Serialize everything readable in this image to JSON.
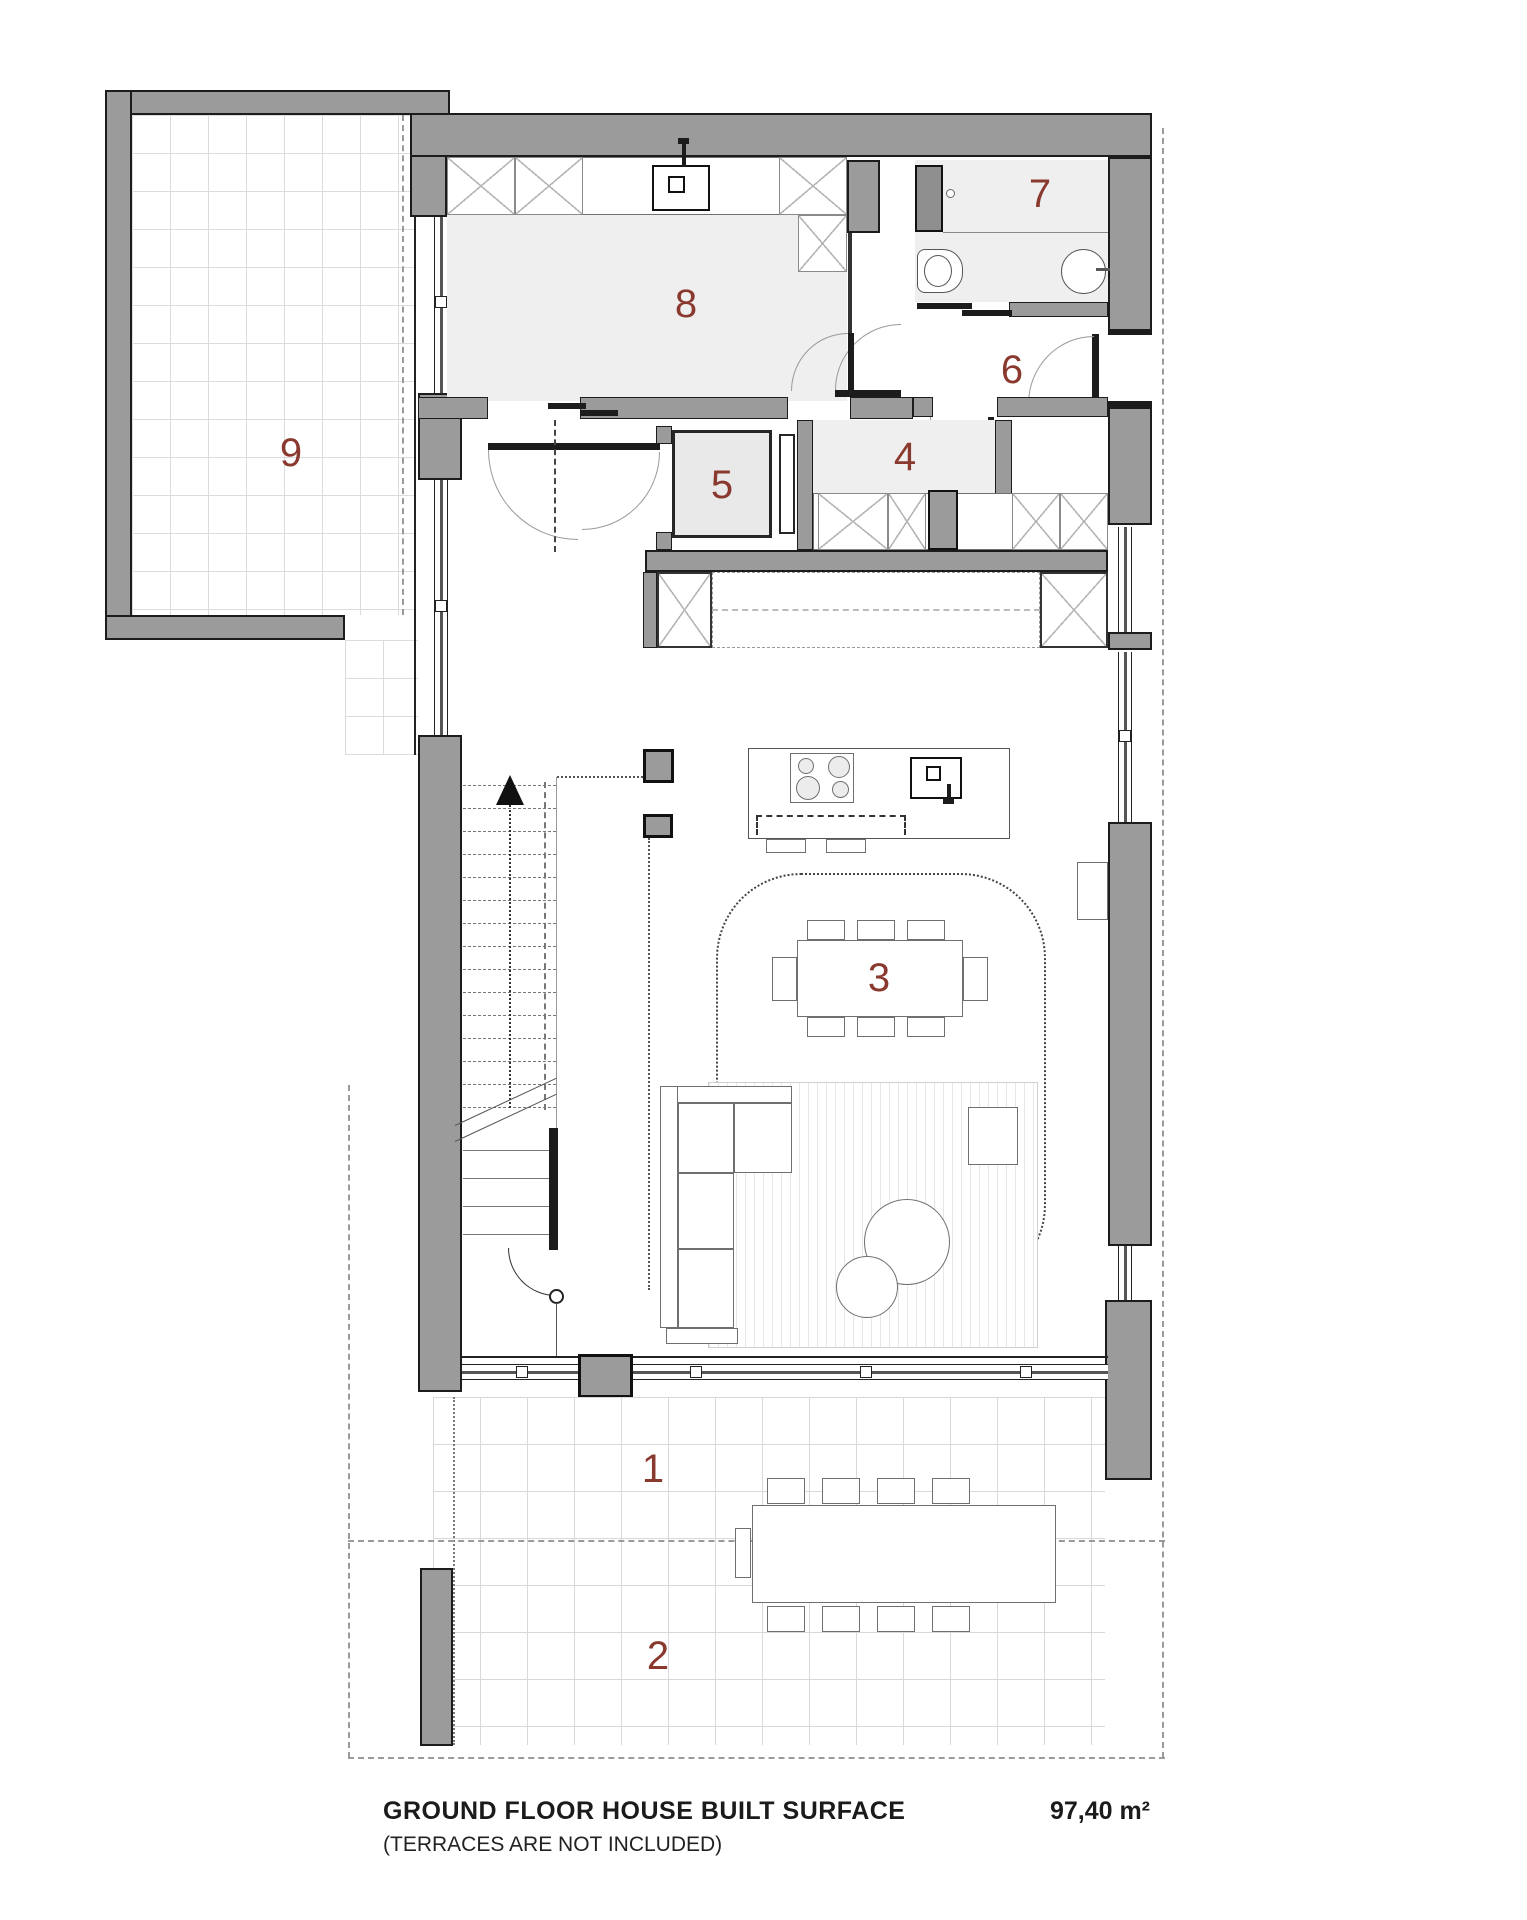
{
  "rooms": {
    "r1": {
      "label": "1"
    },
    "r2": {
      "label": "2"
    },
    "r3": {
      "label": "3"
    },
    "r4": {
      "label": "4"
    },
    "r5": {
      "label": "5"
    },
    "r6": {
      "label": "6"
    },
    "r7": {
      "label": "7"
    },
    "r8": {
      "label": "8"
    },
    "r9": {
      "label": "9"
    }
  },
  "caption": {
    "title": "GROUND FLOOR HOUSE BUILT SURFACE",
    "area": "97,40 m²",
    "note": "(TERRACES ARE NOT INCLUDED)"
  },
  "colors": {
    "wall_gray": "#9b9b9b",
    "floor_gray": "#efeff0",
    "accent_red": "#8a392e"
  }
}
